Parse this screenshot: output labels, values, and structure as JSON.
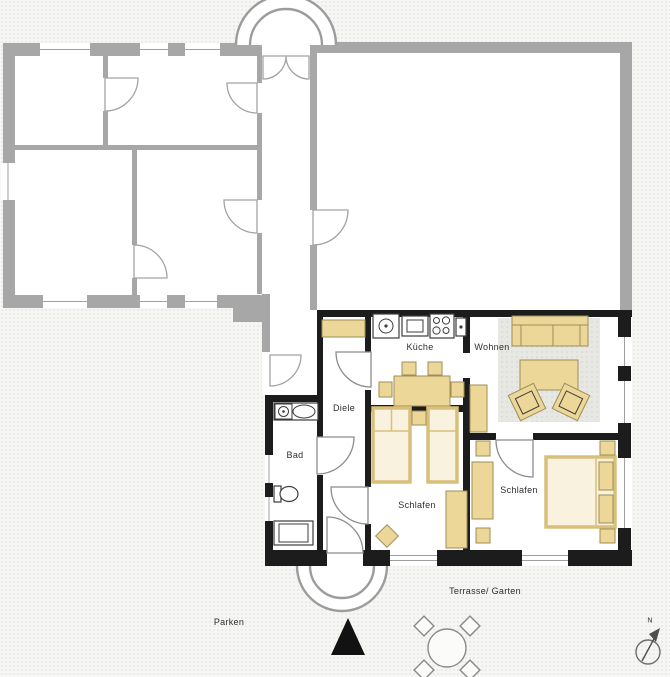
{
  "title": "Floor plan with annexe apartment",
  "colors": {
    "background": "#f6f6f4",
    "old_building_wall": "#a7a7a7",
    "apartment_wall": "#1c1c1c",
    "furniture_fill": "#ecd698",
    "furniture_stroke": "#9d8e57",
    "bed_fill": "#f8f2de",
    "bed_stroke": "#d9c07a",
    "rug_fill": "#e7e7e3"
  },
  "rooms": {
    "kueche": {
      "label": "Küche"
    },
    "wohnen": {
      "label": "Wohnen"
    },
    "diele": {
      "label": "Diele"
    },
    "bad": {
      "label": "Bad"
    },
    "schlafen_left": {
      "label": "Schlafen"
    },
    "schlafen_right": {
      "label": "Schlafen"
    }
  },
  "outside": {
    "terrace_garden_label": "Terrasse/ Garten",
    "parking_label": "Parken"
  },
  "compass": {
    "north_label": "N"
  },
  "icons": [
    "entrance-arch",
    "terrace-arch",
    "entrance-marker-icon",
    "garden-table-icon",
    "north-arrow-icon",
    "sink-icon",
    "stove-icon",
    "oven-icon",
    "toilet-icon",
    "shower-icon",
    "washbasin-icon"
  ]
}
